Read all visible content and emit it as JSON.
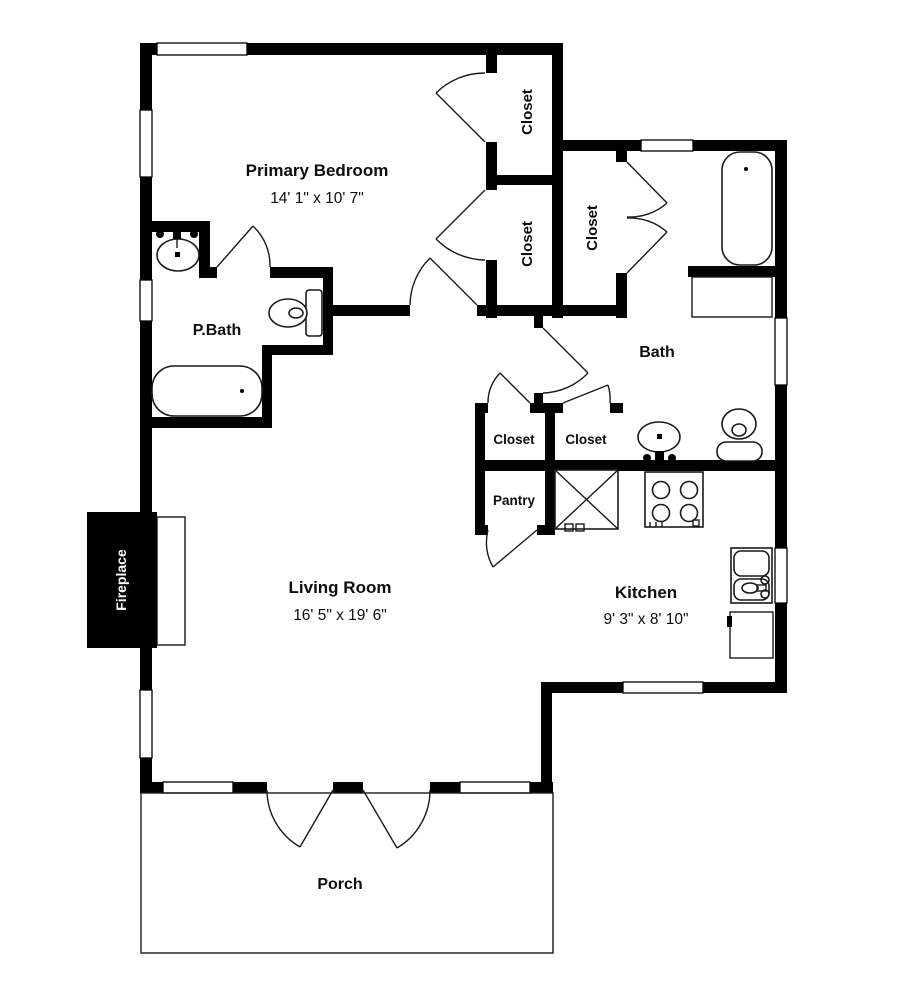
{
  "rooms": {
    "primary_bedroom": {
      "name": "Primary Bedroom",
      "dims": "14' 1\" x 10' 7\""
    },
    "living_room": {
      "name": "Living Room",
      "dims": "16' 5\" x 19' 6\""
    },
    "kitchen": {
      "name": "Kitchen",
      "dims": "9' 3\" x 8' 10\""
    },
    "primary_bath": {
      "name": "P.Bath"
    },
    "bath": {
      "name": "Bath"
    },
    "pantry": {
      "name": "Pantry"
    },
    "porch": {
      "name": "Porch"
    },
    "fireplace": {
      "name": "Fireplace"
    },
    "closet": {
      "name": "Closet"
    }
  },
  "fixtures": [
    "bathtub",
    "toilet",
    "sink",
    "stove",
    "kitchen-sink",
    "dishwasher",
    "appliance",
    "hearth"
  ],
  "colors": {
    "walls": "#000000",
    "background": "#ffffff",
    "lines": "#1a1a1a",
    "fireplace_fill": "#000000",
    "fireplace_text": "#ffffff"
  }
}
